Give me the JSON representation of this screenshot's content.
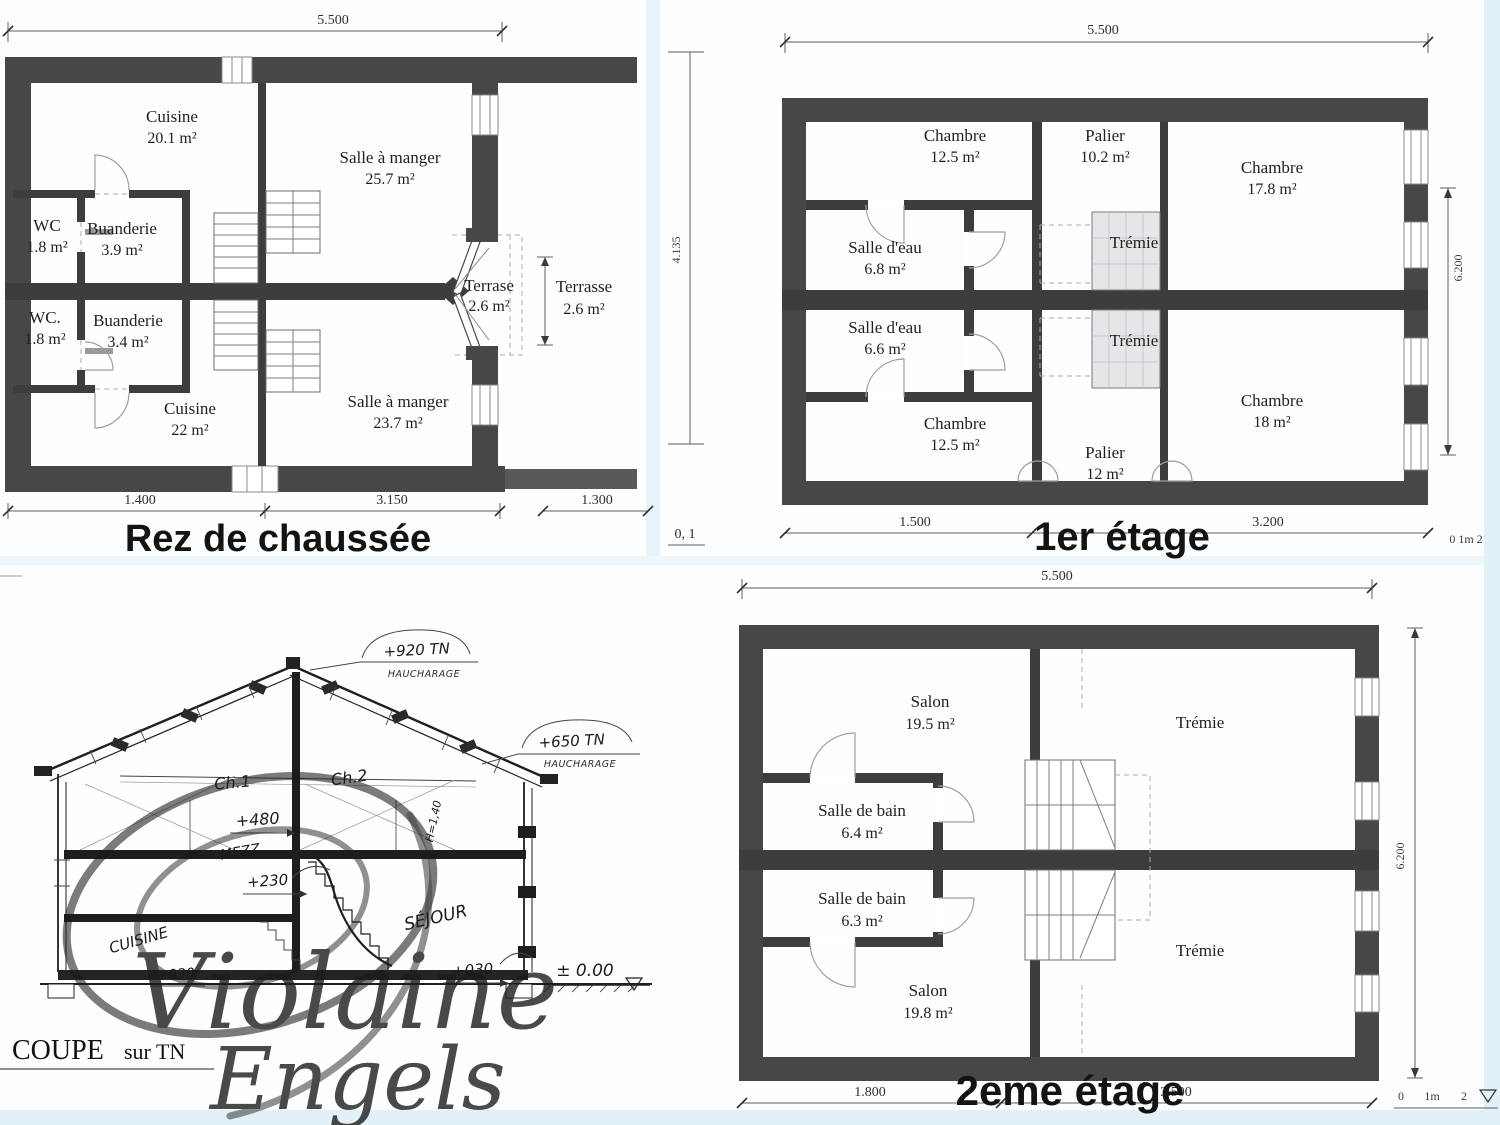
{
  "rdc": {
    "title": "Rez de chaussée",
    "dim_top": "5.500",
    "dims_bottom": [
      "1.400",
      "3.150",
      "1.300"
    ],
    "rooms": [
      {
        "name": "Cuisine",
        "area": "20.1 m²"
      },
      {
        "name": "Salle à manger",
        "area": "25.7 m²"
      },
      {
        "name": "WC",
        "area": "1.8 m²"
      },
      {
        "name": "Buanderie",
        "area": "3.9 m²"
      },
      {
        "name": "WC.",
        "area": "1.8 m²"
      },
      {
        "name": "Buanderie",
        "area": "3.4 m²"
      },
      {
        "name": "Cuisine",
        "area": "22 m²"
      },
      {
        "name": "Salle à manger",
        "area": "23.7 m²"
      },
      {
        "name": "Terrase",
        "area": "2.6 m²"
      },
      {
        "name": "Terrasse",
        "area": "2.6 m²"
      }
    ]
  },
  "etage1": {
    "title": "1er étage",
    "dim_top": "5.500",
    "dim_left": "4.135",
    "dim_right": "6.200",
    "dims_bottom": [
      "1.500",
      "3.200"
    ],
    "scale_left": "0, 1",
    "scale_right": "0  1m  2",
    "rooms": [
      {
        "name": "Chambre",
        "area": "12.5 m²"
      },
      {
        "name": "Palier",
        "area": "10.2 m²"
      },
      {
        "name": "Chambre",
        "area": "17.8 m²"
      },
      {
        "name": "Salle d'eau",
        "area": "6.8 m²"
      },
      {
        "name": "Trémie",
        "area": ""
      },
      {
        "name": "Salle d'eau",
        "area": "6.6 m²"
      },
      {
        "name": "Trémie",
        "area": ""
      },
      {
        "name": "Chambre",
        "area": "12.5 m²"
      },
      {
        "name": "Palier",
        "area": "12 m²"
      },
      {
        "name": "Chambre",
        "area": "18 m²"
      }
    ]
  },
  "coupe": {
    "title_caps": "COUPE",
    "title_rest": "sur TN",
    "labels": {
      "ridge_level": "+920 TN",
      "ridge_note": "HAUCHARAGE",
      "eave_level": "+650 TN",
      "eave_note": "HAUCHARAGE",
      "room1": "Ch.1",
      "room1_level": "+480",
      "room2": "Ch.2",
      "height_note": "H=1,40",
      "mezz": "MEZZ.",
      "mezz_level": "+230",
      "kitchen": "CUISINE",
      "kitchen_level": "+030",
      "living": "SÉJOUR",
      "living_level": "+030",
      "ground_level": "± 0.00"
    },
    "watermark": {
      "line1": "Violaine",
      "line2": "Engels"
    }
  },
  "etage2": {
    "title": "2eme étage",
    "dim_top": "5.500",
    "dim_right": "6.200",
    "dims_bottom": [
      "1.800",
      "3.500"
    ],
    "scale": {
      "zero": "0",
      "one": "1m",
      "two": "2"
    },
    "rooms": [
      {
        "name": "Salon",
        "area": "19.5 m²"
      },
      {
        "name": "Trémie",
        "area": ""
      },
      {
        "name": "Salle de bain",
        "area": "6.4 m²"
      },
      {
        "name": "Salle de bain",
        "area": "6.3 m²"
      },
      {
        "name": "Salon",
        "area": "19.8 m²"
      },
      {
        "name": "Trémie",
        "area": ""
      }
    ]
  }
}
